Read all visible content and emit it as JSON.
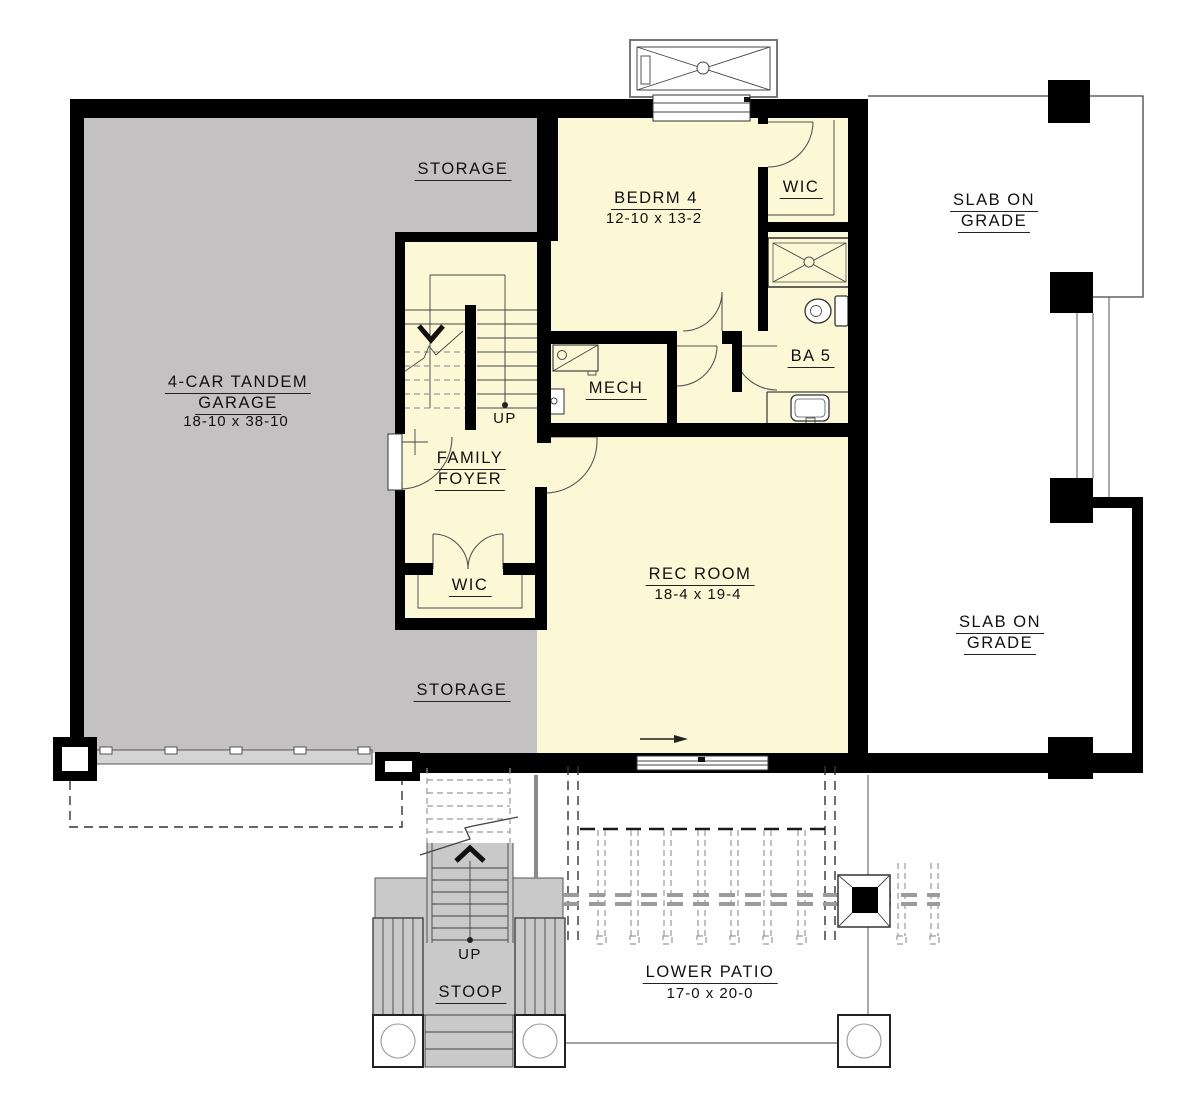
{
  "colors": {
    "wall": "#000000",
    "room": "#FCF7D5",
    "garage": "#C3C1C1",
    "concrete": "#C9C9C9",
    "line": "#444444",
    "dash": "#9a9a9a",
    "bg": "#ffffff"
  },
  "rooms": {
    "storage_top": {
      "label": "STORAGE"
    },
    "bedrm4": {
      "label": "BEDRM 4",
      "dims": "12-10 x 13-2"
    },
    "wic_upper": {
      "label": "WIC"
    },
    "slab_upper": {
      "line1": "SLAB ON",
      "line2": "GRADE"
    },
    "garage": {
      "line1": "4-CAR TANDEM",
      "line2": "GARAGE",
      "dims": "18-10 x 38-10"
    },
    "mech": {
      "label": "MECH"
    },
    "ba5": {
      "label": "BA 5"
    },
    "family_foyer": {
      "line1": "FAMILY",
      "line2": "FOYER"
    },
    "wic_lower": {
      "label": "WIC"
    },
    "rec_room": {
      "label": "REC ROOM",
      "dims": "18-4 x 19-4"
    },
    "storage_bottom": {
      "label": "STORAGE"
    },
    "slab_lower": {
      "line1": "SLAB ON",
      "line2": "GRADE"
    },
    "stoop": {
      "label": "STOOP"
    },
    "lower_patio": {
      "label": "LOWER PATIO",
      "dims": "17-0 x 20-0"
    }
  },
  "annotations": {
    "stair_up_interior": "UP",
    "stair_up_stoop": "UP"
  }
}
